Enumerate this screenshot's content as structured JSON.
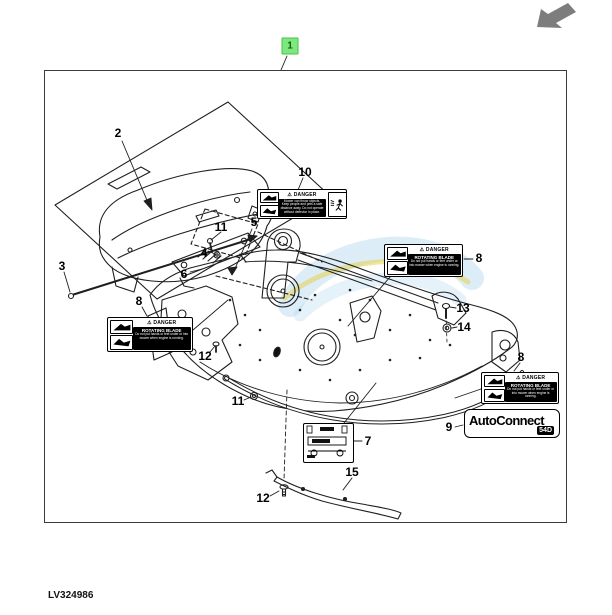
{
  "footer": {
    "part_code": "LV324986"
  },
  "colors": {
    "badge_green_bg": "#7de87d",
    "badge_green_border": "#4bbf4b",
    "badge_green_text": "#145c14",
    "arrow_gray": "#7d7d7d",
    "watermark_blue": "#a9d3ec",
    "watermark_yellow": "#e5d24e"
  },
  "icons": {
    "nav_arrow": "back-arrow-icon"
  },
  "callouts": [
    {
      "id": "1",
      "x": 290,
      "y": 46,
      "badge": true
    },
    {
      "id": "2",
      "x": 118,
      "y": 133
    },
    {
      "id": "3",
      "x": 62,
      "y": 266
    },
    {
      "id": "4",
      "x": 204,
      "y": 253
    },
    {
      "id": "5",
      "x": 254,
      "y": 222
    },
    {
      "id": "6",
      "x": 184,
      "y": 274
    },
    {
      "id": "7",
      "x": 368,
      "y": 441
    },
    {
      "id": "8",
      "x": 139,
      "y": 301
    },
    {
      "id": "8",
      "x": 479,
      "y": 258
    },
    {
      "id": "8",
      "x": 521,
      "y": 357
    },
    {
      "id": "9",
      "x": 449,
      "y": 427
    },
    {
      "id": "10",
      "x": 305,
      "y": 172
    },
    {
      "id": "11",
      "x": 221,
      "y": 227
    },
    {
      "id": "11",
      "x": 238,
      "y": 401
    },
    {
      "id": "12",
      "x": 205,
      "y": 356
    },
    {
      "id": "12",
      "x": 263,
      "y": 498
    },
    {
      "id": "13",
      "x": 463,
      "y": 308
    },
    {
      "id": "14",
      "x": 464,
      "y": 327
    },
    {
      "id": "15",
      "x": 352,
      "y": 472
    }
  ],
  "labels": {
    "rotating_blade": {
      "header": "⚠ DANGER",
      "title": "ROTATING BLADE",
      "body": "Do not put hands or feet under or into mower when engine is running.",
      "instances": [
        {
          "left": 107,
          "top": 317,
          "width": 86,
          "height": 35
        },
        {
          "left": 384,
          "top": 244,
          "width": 79,
          "height": 33
        },
        {
          "left": 481,
          "top": 372,
          "width": 78,
          "height": 32
        }
      ]
    },
    "thrown_objects": {
      "header": "⚠ DANGER",
      "body_lines": [
        "Mower can throw objects.",
        "Keep people and pets a safe",
        "distance away. Do not operate",
        "without deflector in place."
      ]
    }
  },
  "badge_autoconnect": {
    "brand": "AutoConnect",
    "model": "54D"
  }
}
